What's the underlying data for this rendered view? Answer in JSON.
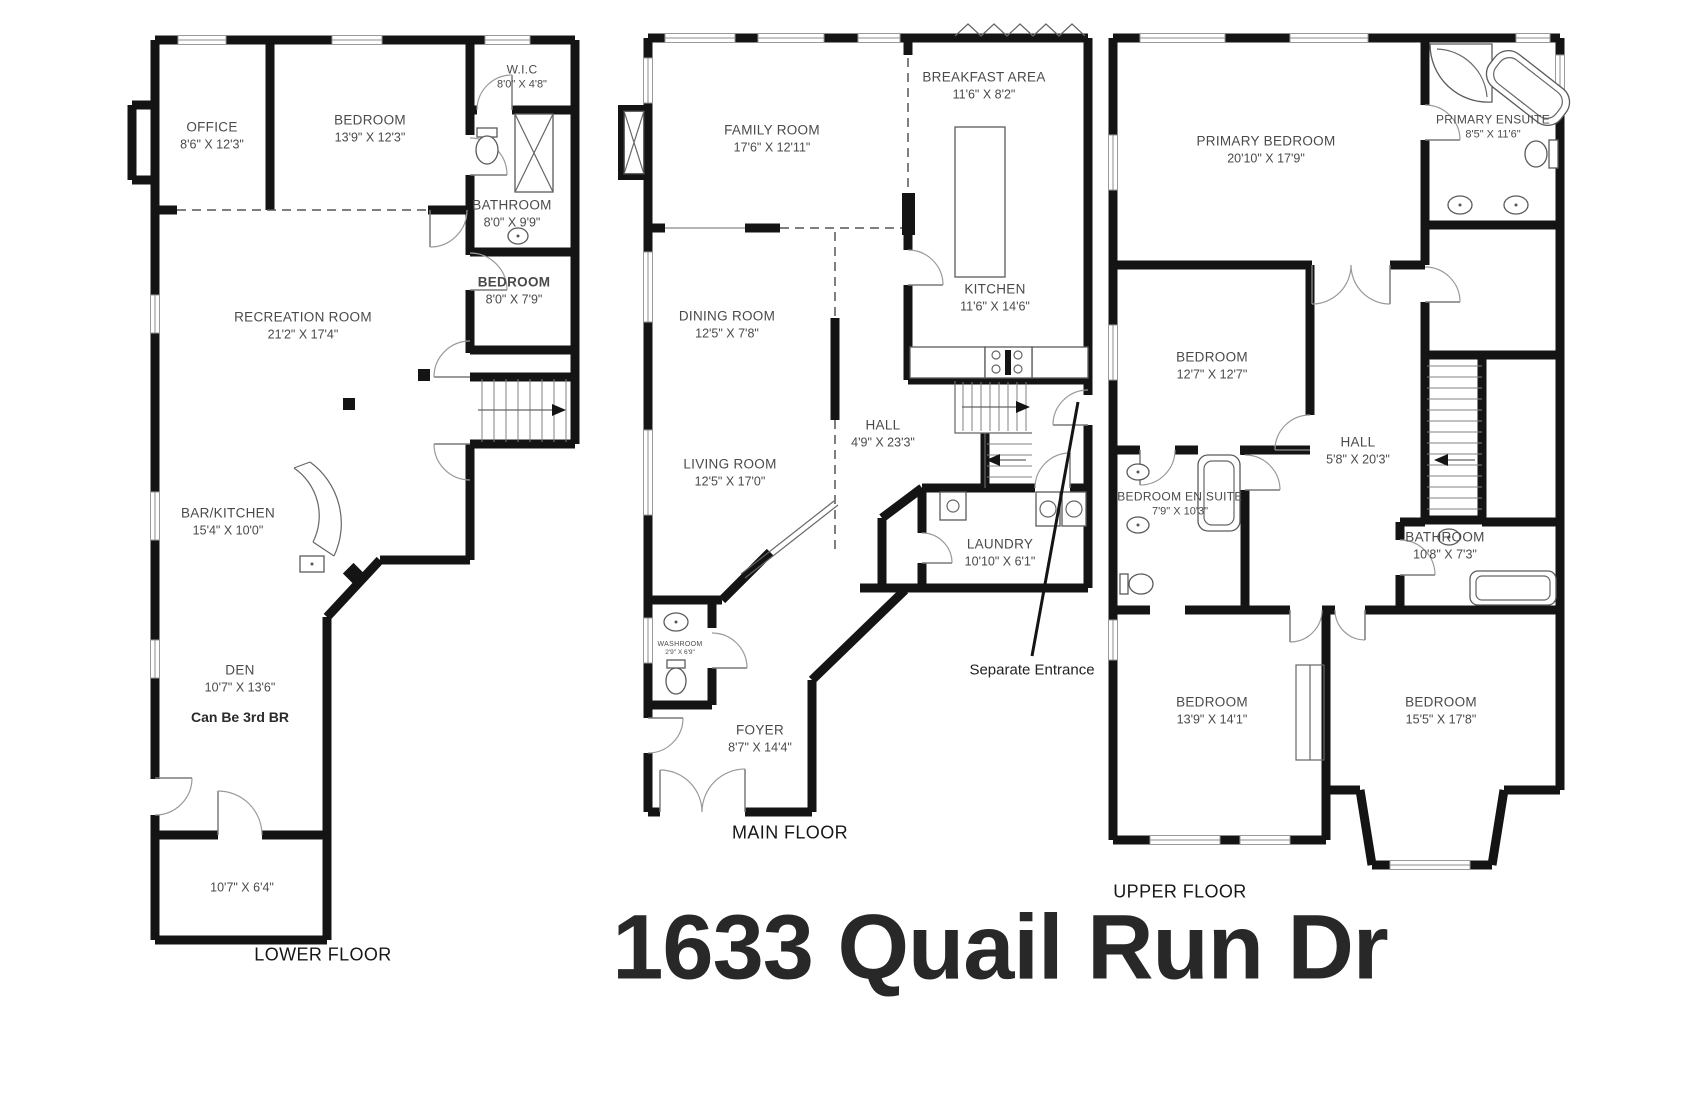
{
  "title": "1633 Quail Run Dr",
  "colors": {
    "walls": "#141414",
    "label_text": "#4a4a4a",
    "background": "#ffffff"
  },
  "fixtures": [
    "stairs",
    "toilet",
    "sink",
    "shower",
    "bathtub",
    "washer-dryer",
    "stove",
    "kitchen-island",
    "bar-counter",
    "fireplace",
    "closet"
  ],
  "floors": {
    "lower": {
      "label": "LOWER FLOOR",
      "rooms": {
        "office": {
          "name": "OFFICE",
          "dims": "8'6\" X 12'3\""
        },
        "bedroom_top": {
          "name": "BEDROOM",
          "dims": "13'9\" X 12'3\""
        },
        "wic": {
          "name": "W.I.C",
          "dims": "8'0\" X 4'8\""
        },
        "bathroom": {
          "name": "BATHROOM",
          "dims": "8'0\" X 9'9\""
        },
        "bedroom_side": {
          "name": "BEDROOM",
          "dims": "8'0\" X 7'9\""
        },
        "recreation": {
          "name": "RECREATION ROOM",
          "dims": "21'2\" X 17'4\""
        },
        "bar_kitchen": {
          "name": "BAR/KITCHEN",
          "dims": "15'4\" X 10'0\""
        },
        "den": {
          "name": "DEN",
          "dims": "10'7\" X 13'6\"",
          "note": "Can Be 3rd BR"
        },
        "storage": {
          "dims": "10'7\" X 6'4\""
        }
      }
    },
    "main": {
      "label": "MAIN FLOOR",
      "annotation": "Separate Entrance",
      "rooms": {
        "family": {
          "name": "FAMILY ROOM",
          "dims": "17'6\" X 12'11\""
        },
        "breakfast": {
          "name": "BREAKFAST AREA",
          "dims": "11'6\" X 8'2\""
        },
        "kitchen": {
          "name": "KITCHEN",
          "dims": "11'6\" X 14'6\""
        },
        "dining": {
          "name": "DINING ROOM",
          "dims": "12'5\" X 7'8\""
        },
        "living": {
          "name": "LIVING ROOM",
          "dims": "12'5\" X 17'0\""
        },
        "hall": {
          "name": "HALL",
          "dims": "4'9\" X 23'3\""
        },
        "laundry": {
          "name": "LAUNDRY",
          "dims": "10'10\" X 6'1\""
        },
        "washroom": {
          "name": "WASHROOM",
          "dims": "2'9\" X 6'9\""
        },
        "foyer": {
          "name": "FOYER",
          "dims": "8'7\" X 14'4\""
        }
      }
    },
    "upper": {
      "label": "UPPER FLOOR",
      "rooms": {
        "primary": {
          "name": "PRIMARY BEDROOM",
          "dims": "20'10\" X 17'9\""
        },
        "primary_ensuite": {
          "name": "PRIMARY ENSUITE",
          "dims": "8'5\" X 11'6\""
        },
        "bedroom_mid": {
          "name": "BEDROOM",
          "dims": "12'7\" X 12'7\""
        },
        "hall": {
          "name": "HALL",
          "dims": "5'8\" X 20'3\""
        },
        "bedroom_ensuite": {
          "name": "BEDROOM EN SUITE",
          "dims": "7'9\" X 10'3\""
        },
        "bathroom": {
          "name": "BATHROOM",
          "dims": "10'8\" X 7'3\""
        },
        "bedroom_left": {
          "name": "BEDROOM",
          "dims": "13'9\" X 14'1\""
        },
        "bedroom_right": {
          "name": "BEDROOM",
          "dims": "15'5\" X 17'8\""
        }
      }
    }
  }
}
